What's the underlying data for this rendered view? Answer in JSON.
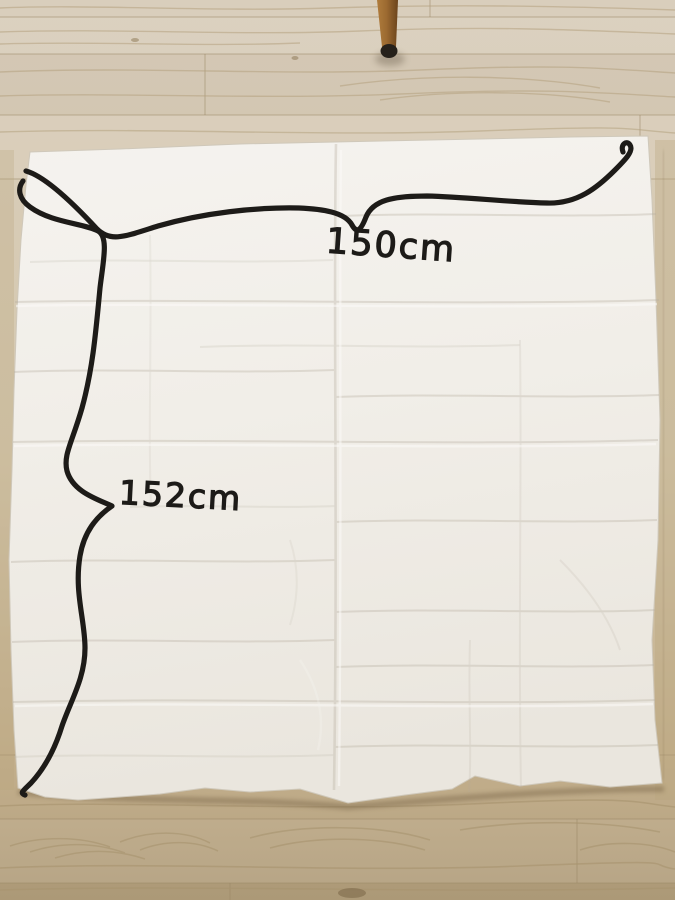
{
  "annotations": {
    "width_label": "150cm",
    "height_label": "152cm"
  },
  "colors": {
    "ink": "#1d1b18",
    "fabric": "#f1eee8",
    "floor_top": "#d9cebc",
    "floor_bottom": "#b3a07f",
    "chair_leg": "#9c6a31"
  }
}
